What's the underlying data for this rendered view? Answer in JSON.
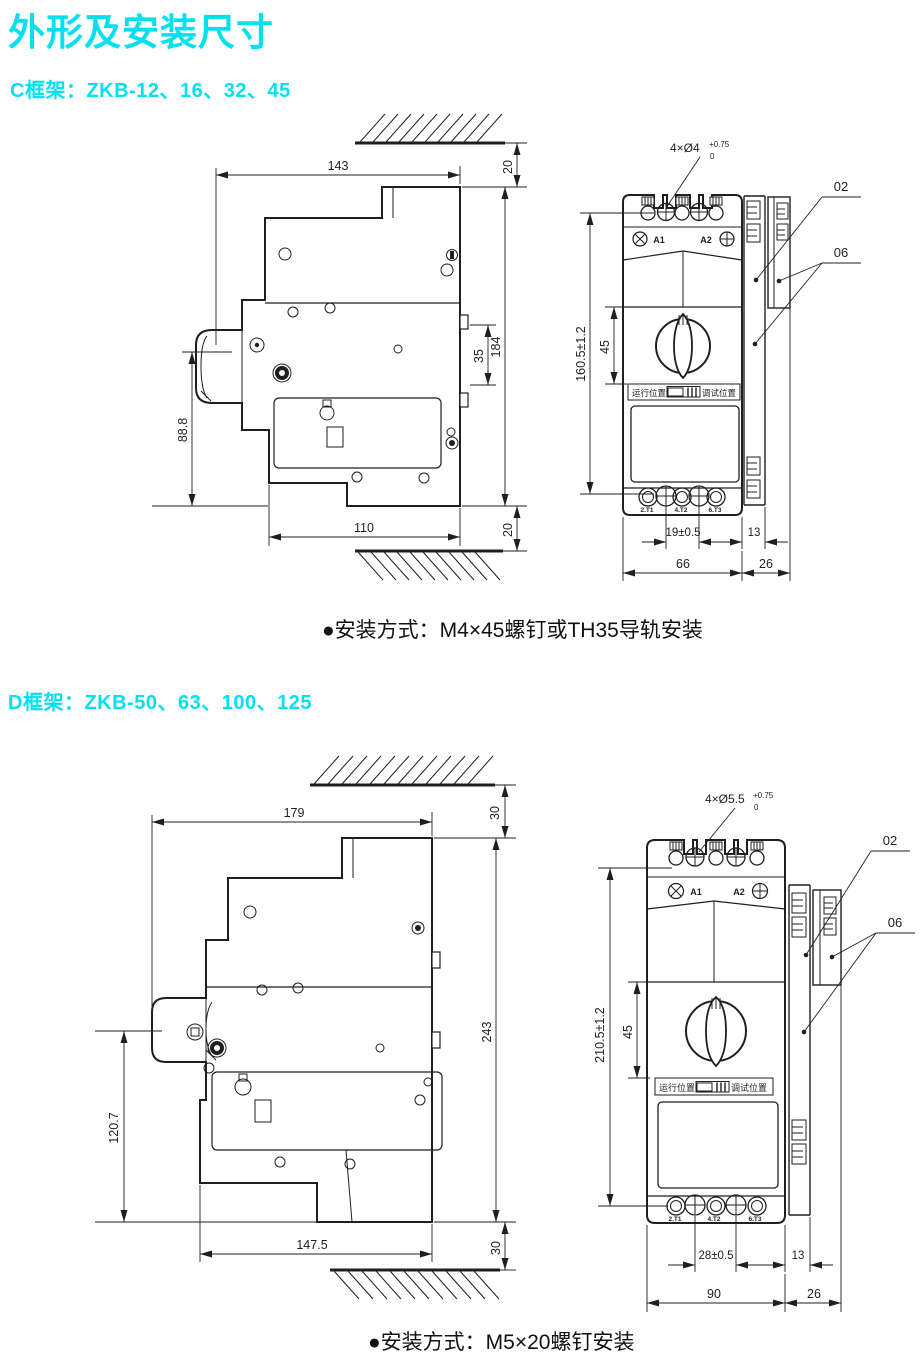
{
  "page": {
    "title": "外形及安装尺寸",
    "accent_color": "#00e1f0",
    "line_color": "#1f1f1f"
  },
  "c_frame": {
    "heading": "C框架：ZKB-12、16、32、45",
    "note": "●安装方式：M4×45螺钉或TH35导轨安装",
    "side_view": {
      "width_top": "143",
      "gap_top": "20",
      "rail_height": "35",
      "height_total": "184",
      "height_front": "88.8",
      "width_bottom": "110",
      "gap_bottom": "20"
    },
    "front_view": {
      "mount_holes": "4×Ø4",
      "hole_tol_upper": "+0.75",
      "hole_tol_lower": "0",
      "callout_02": "02",
      "callout_06": "06",
      "coil_a1": "A1",
      "coil_a2": "A2",
      "height": "160.5±1.2",
      "knob_offset": "45",
      "hole_pitch": "19±0.5",
      "clip_width": "13",
      "width": "66",
      "accessory_width": "26",
      "pos_run": "运行位置",
      "pos_test": "调试位置",
      "term_t1": "2.T1",
      "term_t2": "4.T2",
      "term_t3": "6.T3"
    }
  },
  "d_frame": {
    "heading": "D框架：ZKB-50、63、100、125",
    "note": "●安装方式：M5×20螺钉安装",
    "side_view": {
      "width_top": "179",
      "gap_top": "30",
      "height_total": "243",
      "height_front": "120.7",
      "width_bottom": "147.5",
      "gap_bottom": "30"
    },
    "front_view": {
      "mount_holes": "4×Ø5.5",
      "hole_tol_upper": "+0.75",
      "hole_tol_lower": "0",
      "callout_02": "02",
      "callout_06": "06",
      "coil_a1": "A1",
      "coil_a2": "A2",
      "height": "210.5±1.2",
      "knob_offset": "45",
      "hole_pitch": "28±0.5",
      "clip_width": "13",
      "width": "90",
      "accessory_width": "26",
      "pos_run": "运行位置",
      "pos_test": "调试位置",
      "term_t1": "2.T1",
      "term_t2": "4.T2",
      "term_t3": "6.T3"
    }
  }
}
